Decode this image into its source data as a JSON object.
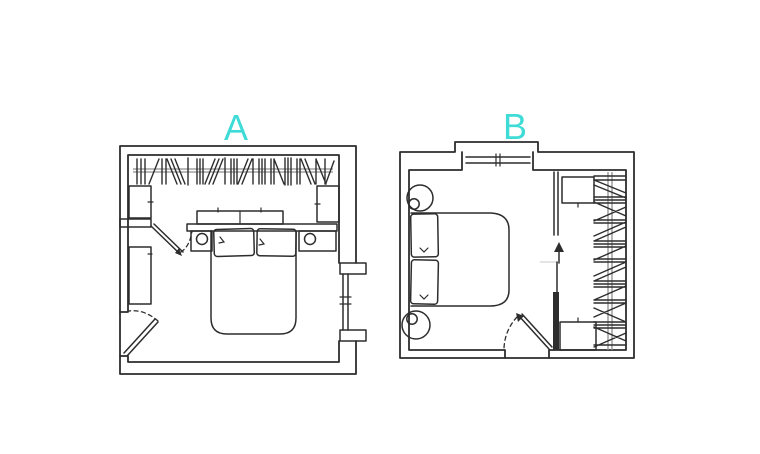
{
  "theme": {
    "background": "#ffffff",
    "ink": "#2d2d2d",
    "accent": "#3edbd7",
    "rail": "#8f8f8f",
    "faint": "#c9c9c9"
  },
  "plans": [
    {
      "label": "A"
    },
    {
      "label": "B"
    }
  ]
}
